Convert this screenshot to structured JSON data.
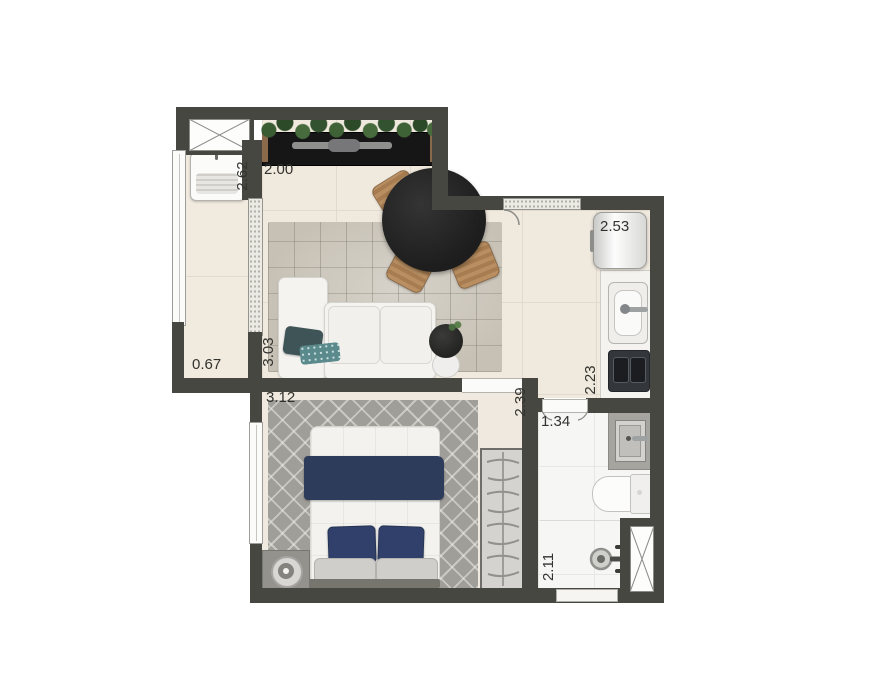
{
  "plan": {
    "dimensions": {
      "laundry_width": "2.62",
      "living_width": "2.00",
      "service_width": "0.67",
      "living_depth": "3.03",
      "bedroom_width": "3.12",
      "bedroom_depth": "2.39",
      "bath_width": "1.34",
      "kitchen_width": "2.53",
      "kitchen_depth": "2.23",
      "bath_depth": "2.11"
    },
    "colors": {
      "wall": "#474741",
      "floor": "#f0e9de",
      "living_rug": "#c7c1b5",
      "bedroom_rug": "#a09e98",
      "navy_accent": "#31406b",
      "plant_green": "#3a5c33",
      "wood": "#b58a5f",
      "table_black": "#202020"
    },
    "icons": {
      "vent_shaft": "crossed-box",
      "hanger": "clothes-hanger",
      "shower": "shower-head",
      "lamp": "round-lamp",
      "plant": "foliage"
    }
  }
}
